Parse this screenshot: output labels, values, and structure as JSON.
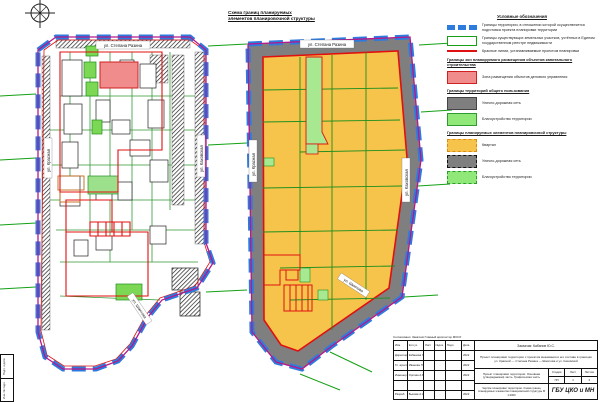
{
  "sheet": {
    "title_line1": "Схема границ планируемых",
    "title_line2": "элементов планировочной структуры"
  },
  "colors": {
    "boundary_blue": "#2e7bde",
    "boundary_magenta": "#b5178c",
    "red_lines": "#e01010",
    "plot_green": "#1e8e1e",
    "quarter_yellow": "#f6c44b",
    "road_gray": "#7f7f7f",
    "landscaping_green": "#90e878",
    "business_pink": "#f08c8c"
  },
  "maps": {
    "left": {
      "street_top": "ул. Степана Разина",
      "street_left": "ул. Красная",
      "street_right": "ул. Каховская",
      "street_diagonal": "ул. Шмитова"
    },
    "right": {
      "street_top": "ул. Степана Разина",
      "street_left": "ул. Красная",
      "street_right": "ул. Каховская",
      "street_diagonal": "ул. Шмитова"
    }
  },
  "legend": {
    "header": "Условные обозначения",
    "groups": [
      {
        "header": "",
        "items": [
          {
            "label": "Границы территории, в отношении которой осуществляется подготовка проекта планировки территории"
          },
          {
            "label": "Границы существующих земельных участков, учтённых в Едином государственном реестре недвижимости"
          },
          {
            "label": "Красные линии, устанавливаемые проектом планировки"
          }
        ]
      },
      {
        "header": "Границы зон планируемого размещения объектов капитального строительства",
        "items": [
          {
            "label": "Зона размещения объектов делового управления"
          }
        ]
      },
      {
        "header": "Границы территорий общего пользования",
        "items": [
          {
            "label": "Улично-дорожная сеть"
          },
          {
            "label": "Благоустройство территории"
          }
        ]
      },
      {
        "header": "Границы планируемых элементов планировочной структуры",
        "items": [
          {
            "label": "Квартал"
          },
          {
            "label": "Улично-дорожная сеть"
          },
          {
            "label": "Благоустройство территории"
          }
        ]
      }
    ]
  },
  "titleblock": {
    "approval_line": "Согласовано: Заказчик   Главный архитектор   МОСХ",
    "customer": "Заказчик: Кабанов Ю.С.",
    "project": "Проект планировки территории с проектом межевания в его составе в границах ул. Красной — Степана Разина — Шмитова и ул. Каховской",
    "doc_title": "Проект планировки территории. Основная (утверждаемая) часть. Графическая часть",
    "sheet_caption": "Чертёж планировки территории. Схема границ планируемых элементов планировочной структуры М 1:2000",
    "organization": "ГБУ ЦКО и МН",
    "stage_label": "Стадия",
    "sheet_label": "Лист",
    "sheets_label": "Листов",
    "stage": "ПП",
    "sheet": "1",
    "sheets": "4",
    "columns": [
      "Изм.",
      "Кол.уч.",
      "Лист",
      "№док.",
      "Подп.",
      "Дата"
    ],
    "rows": [
      {
        "role": "Директор",
        "name": "Кабанова Г.В.",
        "date": "2022"
      },
      {
        "role": "Гл. архит.",
        "name": "Иванова П.В.",
        "date": "2022"
      },
      {
        "role": "Инженер",
        "name": "Орлова А.В.",
        "date": "2022"
      },
      {
        "role": "",
        "name": "",
        "date": ""
      },
      {
        "role": "Разраб.",
        "name": "Быкова А.А.",
        "date": "2022"
      }
    ]
  },
  "side_stamp": {
    "cell1": "Подп. и дата",
    "cell2": "Инв. № подл."
  }
}
